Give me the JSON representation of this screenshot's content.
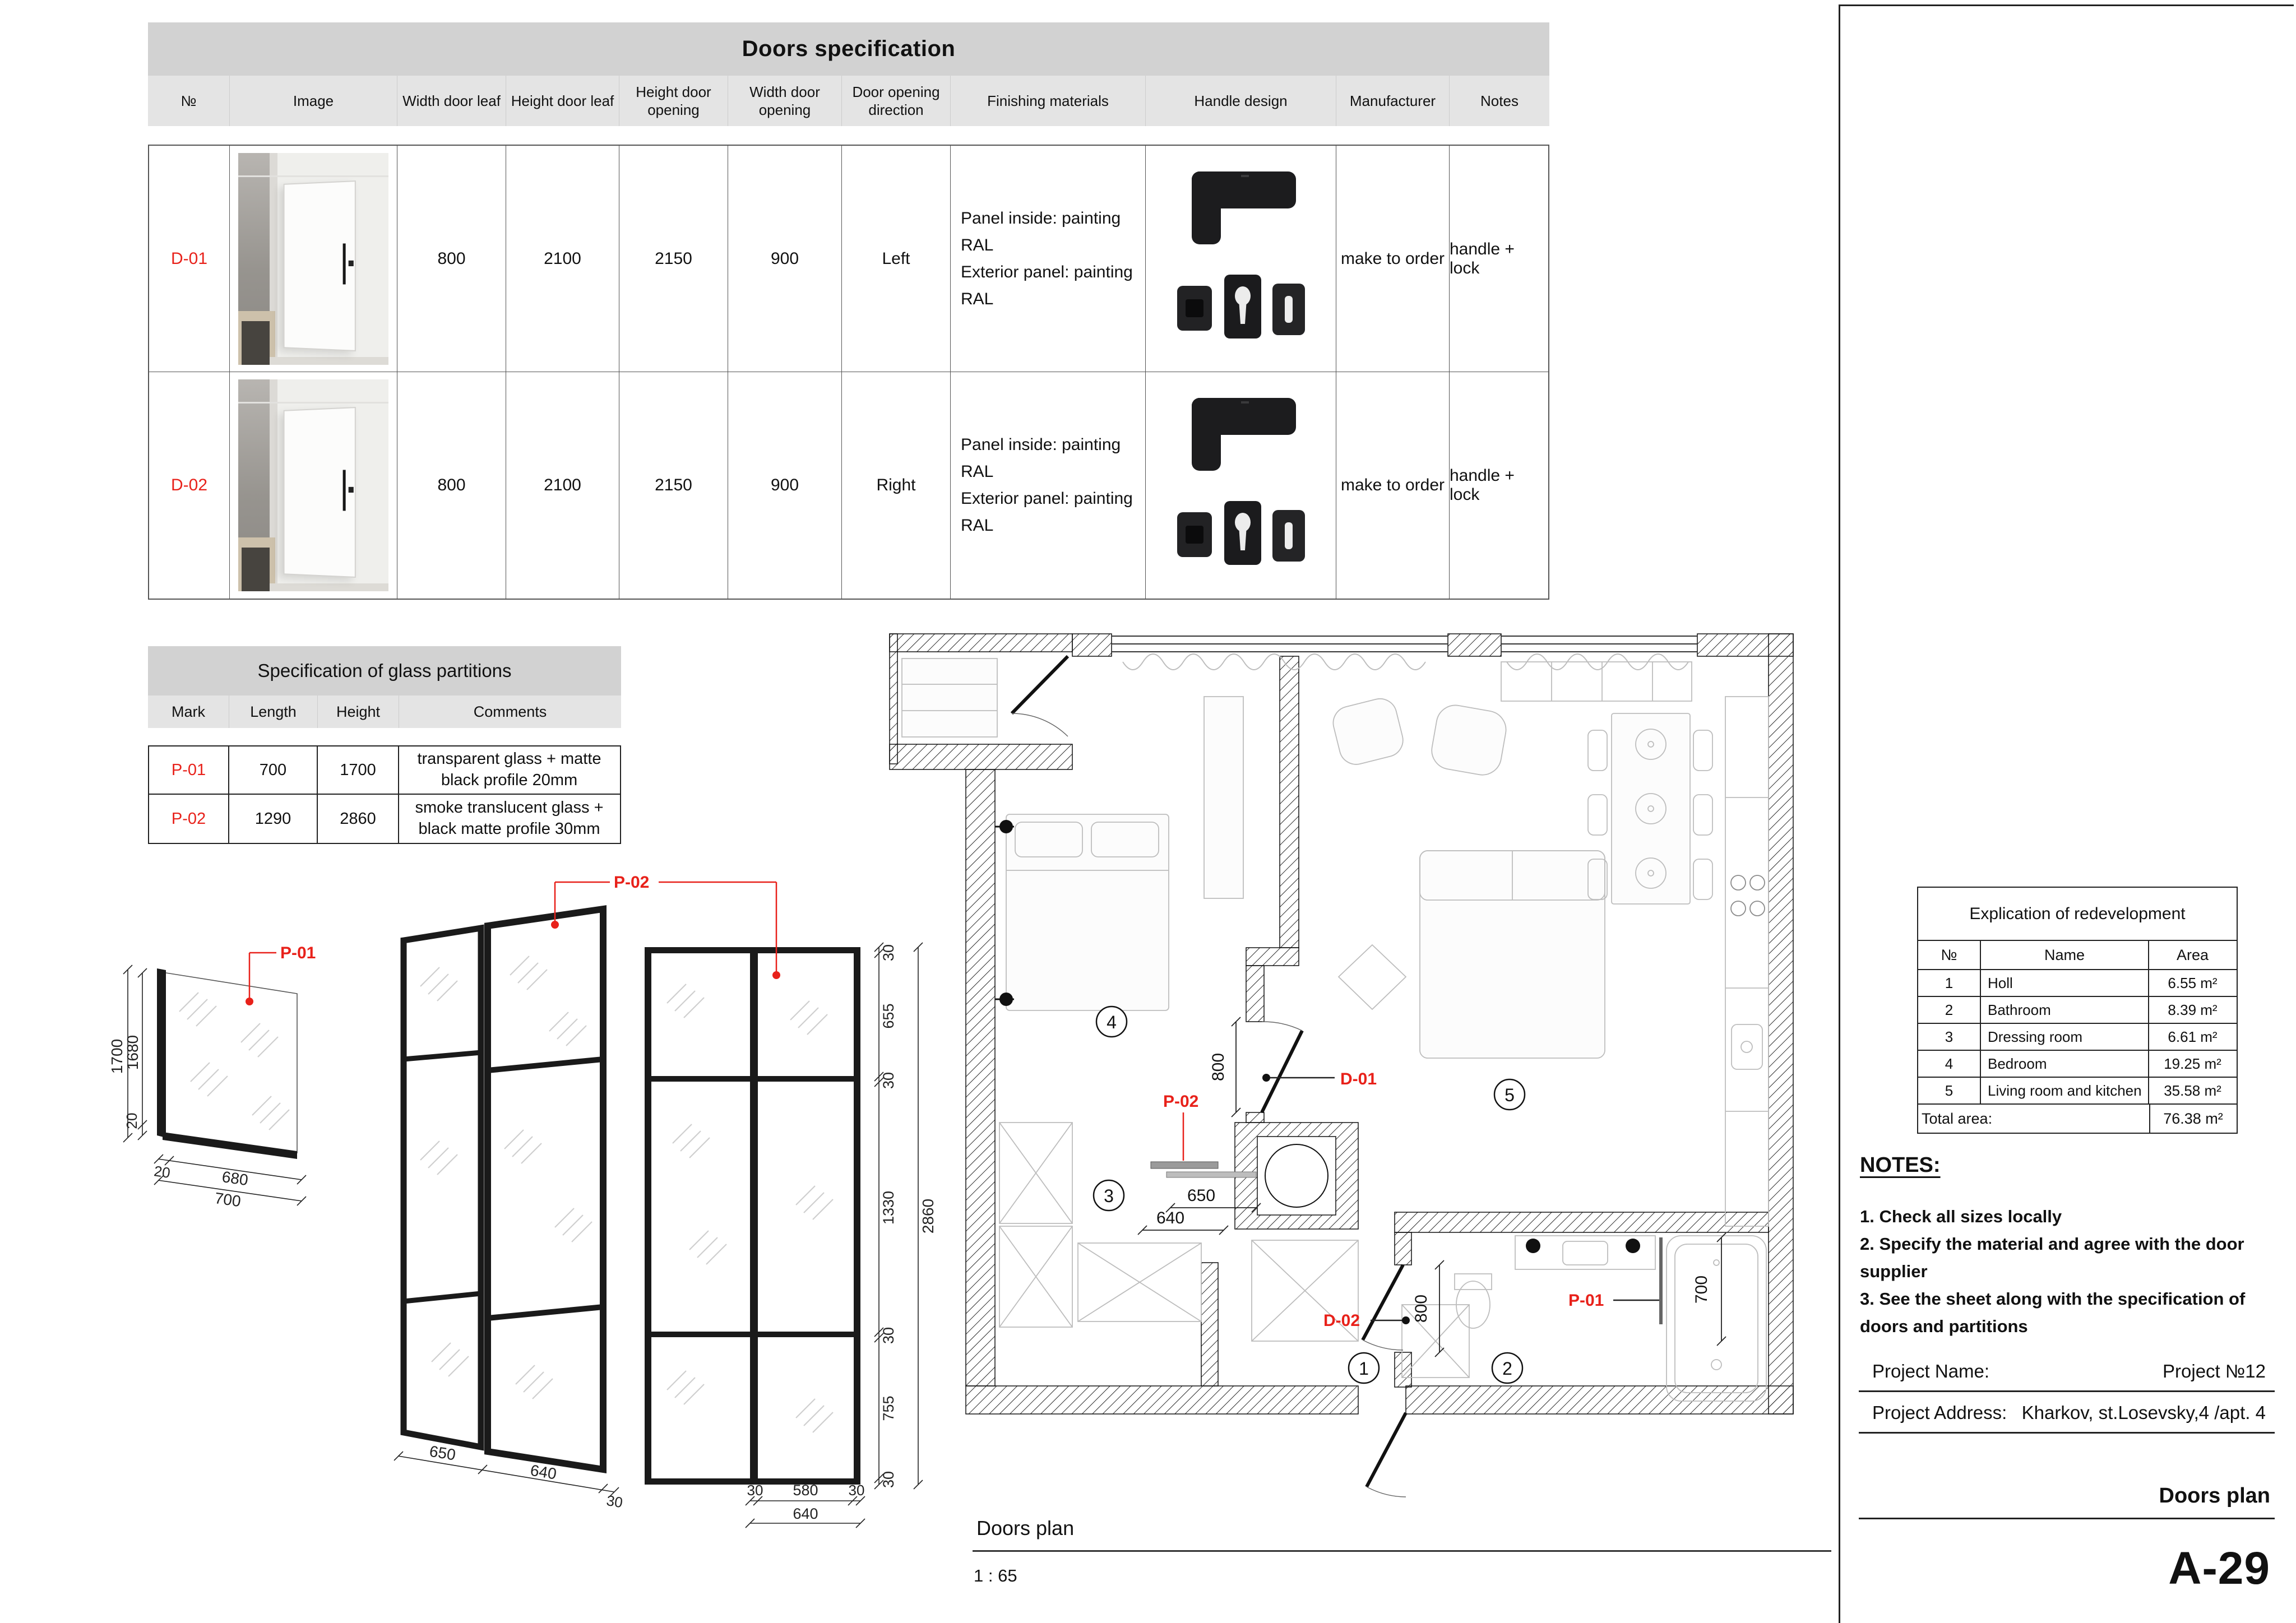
{
  "colors": {
    "accent_red": "#e8211a",
    "table_title_bg": "#d2d2d2",
    "table_header_bg": "#e4e4e4"
  },
  "doors_table": {
    "title": "Doors specification",
    "columns": [
      "№",
      "Image",
      "Width door leaf",
      "Height door leaf",
      "Height door opening",
      "Width door opening",
      "Door opening direction",
      "Finishing materials",
      "Handle design",
      "Manufacturer",
      "Notes"
    ],
    "rows": [
      {
        "id": "D-01",
        "width_leaf": "800",
        "height_leaf": "2100",
        "height_opening": "2150",
        "width_opening": "900",
        "direction": "Left",
        "finishing_1": "Panel inside: painting RAL",
        "finishing_2": "Exterior panel: painting RAL",
        "manufacturer": "make to order",
        "notes": "handle + lock"
      },
      {
        "id": "D-02",
        "width_leaf": "800",
        "height_leaf": "2100",
        "height_opening": "2150",
        "width_opening": "900",
        "direction": "Right",
        "finishing_1": "Panel inside: painting RAL",
        "finishing_2": "Exterior panel: painting RAL",
        "manufacturer": "make to order",
        "notes": "handle + lock"
      }
    ]
  },
  "partitions_table": {
    "title": "Specification of glass partitions",
    "columns": [
      "Mark",
      "Length",
      "Height",
      "Comments"
    ],
    "rows": [
      {
        "mark": "P-01",
        "length": "700",
        "height": "1700",
        "comments": "transparent glass + matte black profile 20mm"
      },
      {
        "mark": "P-02",
        "length": "1290",
        "height": "2860",
        "comments": "smoke translucent glass + black matte profile 30mm"
      }
    ]
  },
  "p01_drawing": {
    "label": "P-01",
    "h_total": "1700",
    "h_glass": "1680",
    "h_bottom": "20",
    "w_profile": "20",
    "w_glass": "680",
    "w_total": "700"
  },
  "p02_drawing": {
    "label": "P-02",
    "iso_left": "650",
    "iso_right": "640",
    "iso_profile": "30",
    "chain": [
      "30",
      "655",
      "30",
      "1330",
      "30",
      "755",
      "30"
    ],
    "h_total": "2860",
    "bottom_chain": [
      "30",
      "580",
      "30"
    ],
    "w_total": "640"
  },
  "plan": {
    "title": "Doors plan",
    "scale": "1 : 65",
    "rooms": [
      "1",
      "2",
      "3",
      "4",
      "5"
    ],
    "labels": {
      "d01": "D-01",
      "d02": "D-02",
      "p01": "P-01",
      "p02": "P-02"
    },
    "dims": {
      "d01": "800",
      "d02": "800",
      "len_a": "650",
      "len_b": "640",
      "tub": "700"
    }
  },
  "explication": {
    "title": "Explication of redevelopment",
    "columns": [
      "№",
      "Name",
      "Area"
    ],
    "rows": [
      {
        "no": "1",
        "name": "Holl",
        "area": "6.55 m²"
      },
      {
        "no": "2",
        "name": "Bathroom",
        "area": "8.39 m²"
      },
      {
        "no": "3",
        "name": "Dressing room",
        "area": "6.61 m²"
      },
      {
        "no": "4",
        "name": "Bedroom",
        "area": "19.25 m²"
      },
      {
        "no": "5",
        "name": "Living room and kitchen",
        "area": "35.58 m²"
      }
    ],
    "total_label": "Total area:",
    "total_value": "76.38 m²"
  },
  "notes": {
    "title": "NOTES:",
    "items": [
      "1. Check all sizes locally",
      "2. Specify the material and agree with the door supplier",
      "3. See the sheet along with the specification of doors and partitions"
    ]
  },
  "title_block": {
    "project_name_label": "Project Name:",
    "project_name": "Project №12",
    "project_address_label": "Project Address:",
    "project_address": "Kharkov, st.Losevsky,4 /apt. 4",
    "sheet_title": "Doors  plan",
    "sheet_number": "A-29"
  }
}
